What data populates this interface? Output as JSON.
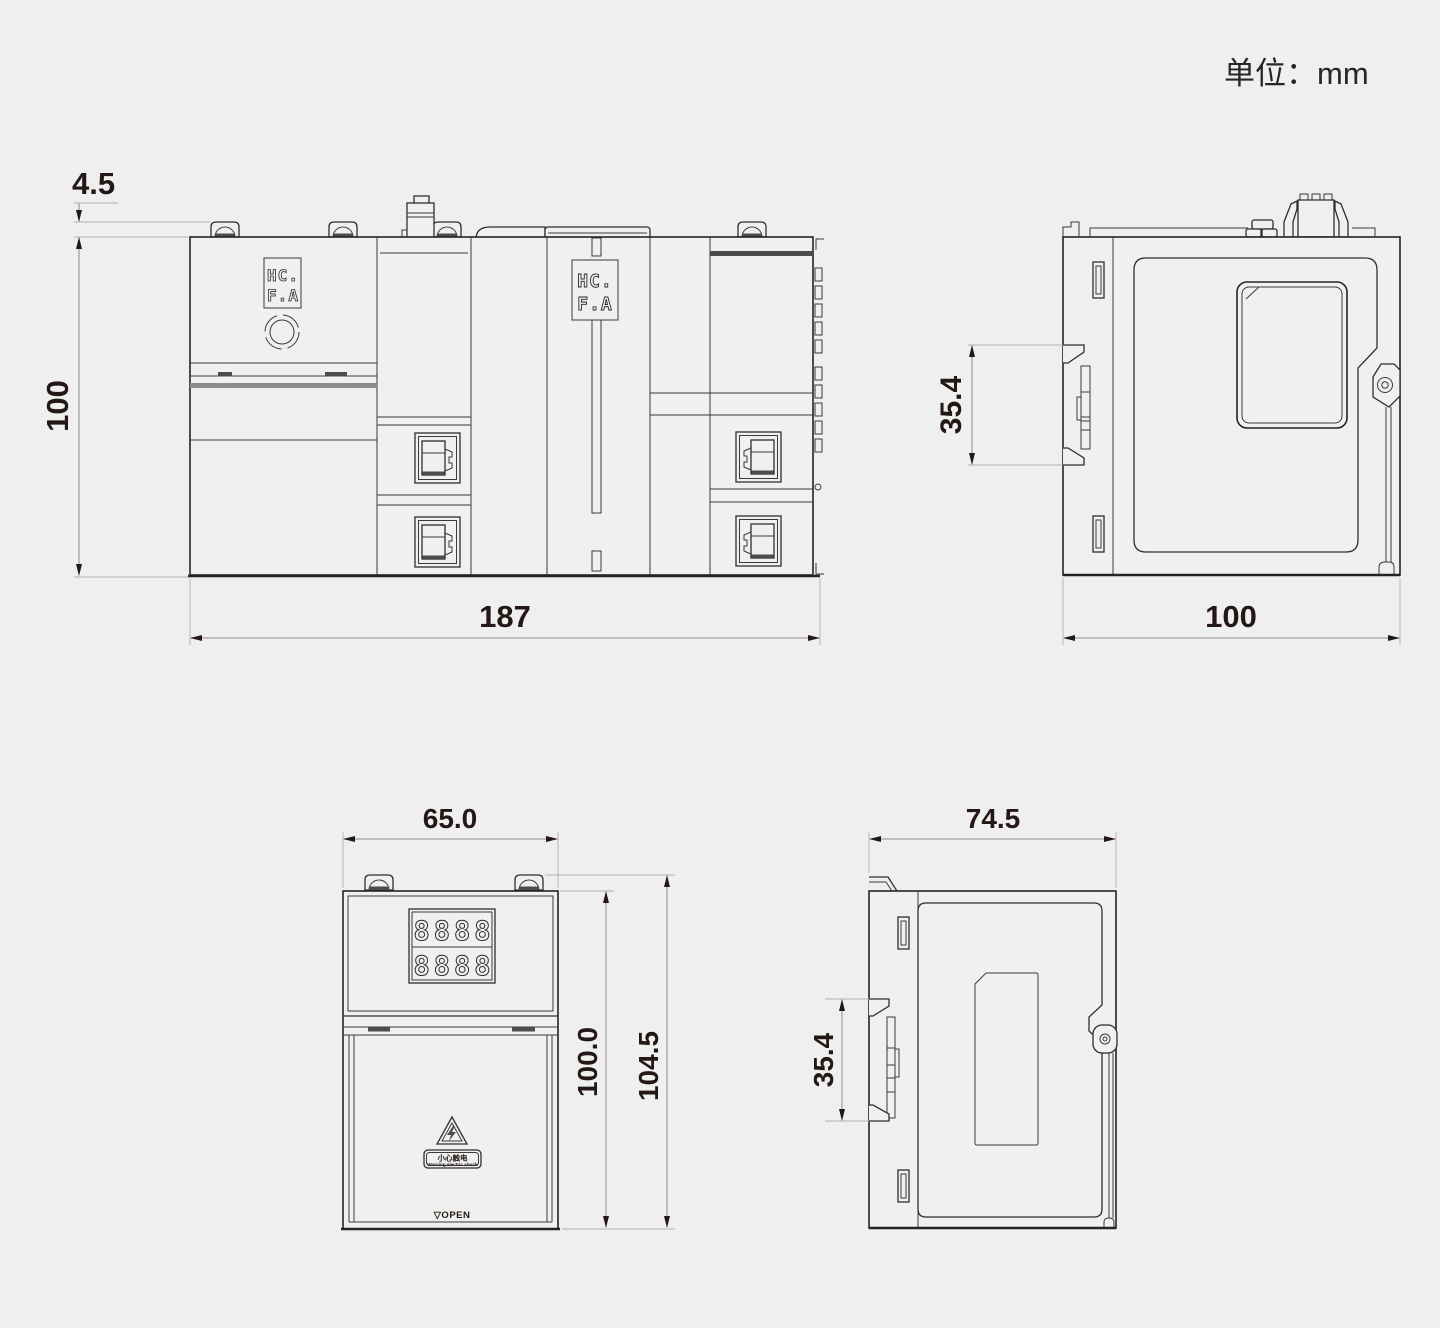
{
  "unit_label": "单位：mm",
  "colors": {
    "background": "#efefef",
    "line": "#242424",
    "dimension_text": "#231815"
  },
  "brand": {
    "line1": "HC.",
    "line2": "F.A"
  },
  "assembly_front": {
    "dims": {
      "clip": "4.5",
      "height": "100",
      "width": "187"
    }
  },
  "assembly_side": {
    "dims": {
      "din_clip": "35.4",
      "depth": "100"
    }
  },
  "module_front": {
    "dims": {
      "width": "65.0",
      "body_height": "100.0",
      "total_height": "104.5"
    },
    "display": {
      "row1": "8888",
      "row2": "8888"
    },
    "warning": {
      "cn": "小心触电",
      "en": "Warning electric shock"
    },
    "open_label": "▽OPEN"
  },
  "module_side": {
    "dims": {
      "depth": "74.5",
      "din_clip": "35.4"
    }
  }
}
